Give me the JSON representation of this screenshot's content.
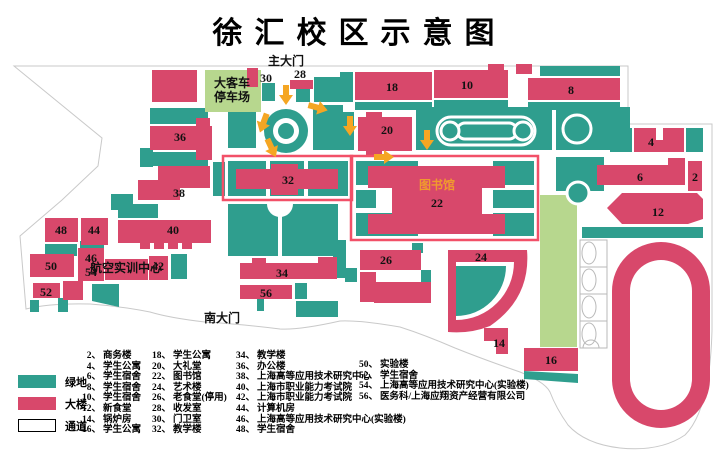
{
  "title": "徐汇校区示意图",
  "colors": {
    "teal": "#2f9e8e",
    "pink": "#d8486b",
    "lightgreen": "#b7d78e",
    "orange": "#f5a623",
    "outline": "#f25068",
    "boundary": "#c9c9c9",
    "courtline": "#b9b9b9",
    "libtext": "#f09a2e"
  },
  "map": {
    "labels": {
      "main_gate": "主大门",
      "south_gate": "南大门",
      "bus1": "大客车",
      "bus2": "停车场",
      "lib": "图书馆",
      "aviation": "航空实训中心",
      "b2": "2",
      "b4": "4",
      "b6": "6",
      "b8": "8",
      "b10": "10",
      "b12": "12",
      "b14": "14",
      "b16": "16",
      "b18": "18",
      "b20": "20",
      "b22": "22",
      "b24": "24",
      "b26": "26",
      "b28": "28",
      "b30": "30",
      "b32": "32",
      "b34": "34",
      "b36": "36",
      "b38": "38",
      "b40": "40",
      "b42": "42",
      "b44": "44",
      "b46": "46",
      "b48": "48",
      "b50": "50",
      "b52": "52",
      "b54": "54",
      "b56": "56"
    }
  },
  "legend": {
    "items": [
      {
        "label": "绿地",
        "type": "green"
      },
      {
        "label": "大楼",
        "type": "building"
      },
      {
        "label": "通道",
        "type": "path"
      }
    ]
  },
  "directory": {
    "col1": [
      {
        "no": "2、",
        "name": "商务楼"
      },
      {
        "no": "4、",
        "name": "学生公寓"
      },
      {
        "no": "6、",
        "name": "学生宿舍"
      },
      {
        "no": "8、",
        "name": "学生宿舍"
      },
      {
        "no": "10、",
        "name": "学生宿舍"
      },
      {
        "no": "12、",
        "name": "新食堂"
      },
      {
        "no": "14、",
        "name": "锅炉房"
      },
      {
        "no": "16、",
        "name": "学生公寓"
      }
    ],
    "col2": [
      {
        "no": "18、",
        "name": "学生公寓"
      },
      {
        "no": "20、",
        "name": "大礼堂"
      },
      {
        "no": "22、",
        "name": "图书馆"
      },
      {
        "no": "24、",
        "name": "艺术楼"
      },
      {
        "no": "26、",
        "name": "老食堂(停用)"
      },
      {
        "no": "28、",
        "name": "收发室"
      },
      {
        "no": "30、",
        "name": "门卫室"
      },
      {
        "no": "32、",
        "name": "教学楼"
      }
    ],
    "col3": [
      {
        "no": "34、",
        "name": "教学楼"
      },
      {
        "no": "36、",
        "name": "办公楼"
      },
      {
        "no": "38、",
        "name": "上海高等应用技术研究中心"
      },
      {
        "no": "40、",
        "name": "上海市职业能力考试院"
      },
      {
        "no": "42、",
        "name": "上海市职业能力考试院"
      },
      {
        "no": "44、",
        "name": "计算机房"
      },
      {
        "no": "46、",
        "name": "上海高等应用技术研究中心(实验楼)"
      },
      {
        "no": "48、",
        "name": "学生宿舍"
      }
    ],
    "col4": [
      {
        "no": "50、",
        "name": "实验楼"
      },
      {
        "no": "52、",
        "name": "学生宿舍"
      },
      {
        "no": "54、",
        "name": "上海高等应用技术研究中心(实验楼)"
      },
      {
        "no": "56、",
        "name": "医务科/上海应翔资产经营有限公司"
      }
    ]
  }
}
